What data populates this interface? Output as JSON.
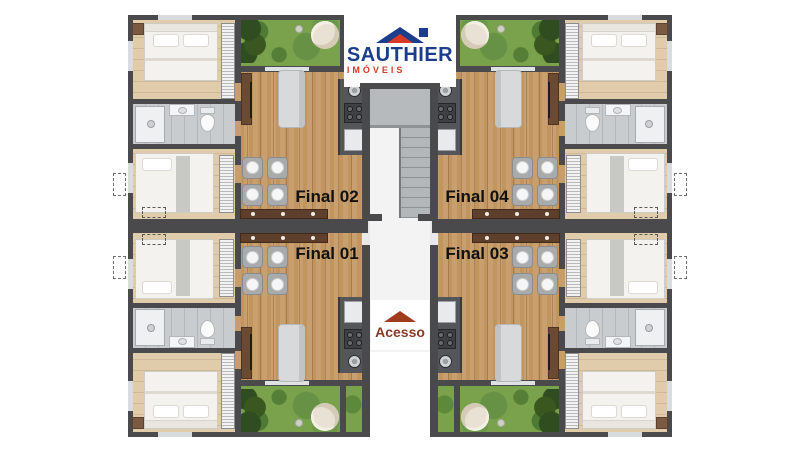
{
  "page": {
    "background": "#ffffff",
    "type": "apartment-floor-plan"
  },
  "logo": {
    "name": "SAUTHIER",
    "subtitle": "IMÓVEIS",
    "name_color": "#1c3d8c",
    "subtitle_color": "#d93a28"
  },
  "access": {
    "label": "Acesso",
    "text_color": "#8a3a22",
    "arrow_color": "#a03b1d"
  },
  "unit_labels": {
    "final_01": "Final 01",
    "final_02": "Final 02",
    "final_03": "Final 03",
    "final_04": "Final 04"
  },
  "label_color": "#111111",
  "colors": {
    "wall": "#4a4a4d",
    "living_floor": "#c2955f",
    "bedroom_floor": "#e0ccab",
    "bathroom_floor": "#c9cccf",
    "garden_grass": "#7aa14c",
    "stairs_concrete": "#b4b7b9",
    "kitchen_counter": "#55565a",
    "sideboard_wood": "#5e3f2c",
    "sofa": "#d8d9da"
  }
}
